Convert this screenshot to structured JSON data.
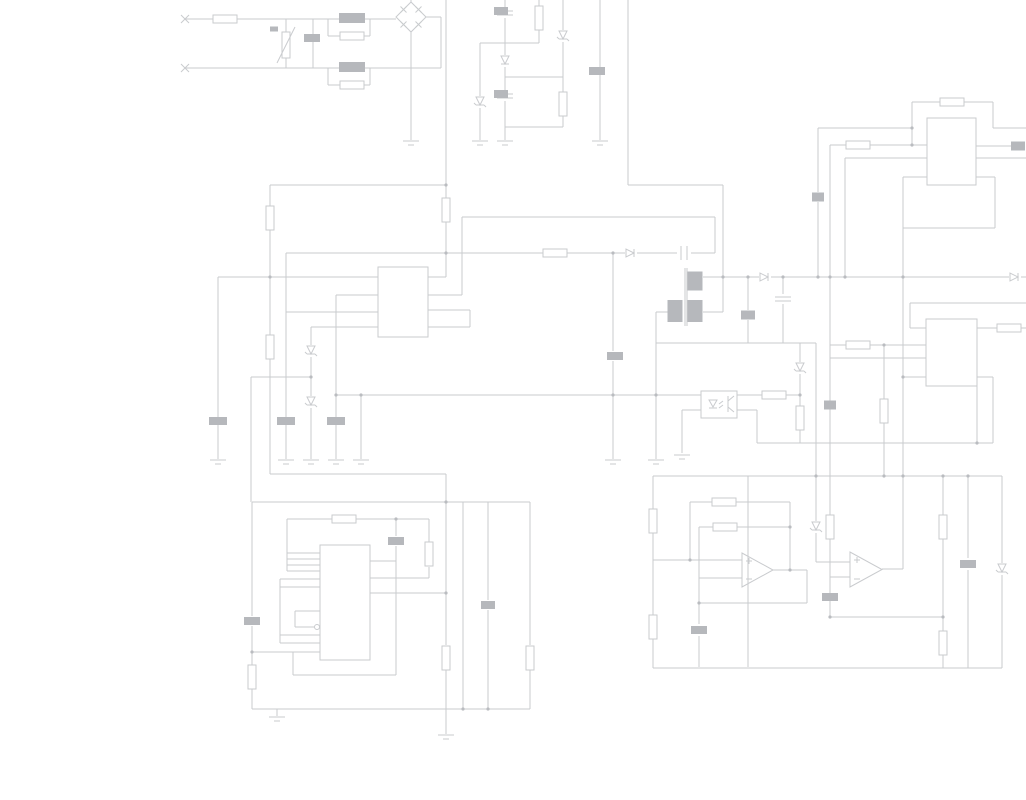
{
  "meta": {
    "type": "circuit-schematic",
    "width": 1026,
    "height": 800,
    "background": "#ffffff",
    "wire_color": "#c9cbce",
    "blob_color": "#b6b8bc",
    "dot_color": "#babcc0"
  },
  "wires": [
    [
      185,
      19,
      213,
      19
    ],
    [
      237,
      19,
      396,
      19
    ],
    [
      185,
      68,
      441,
      68
    ],
    [
      441,
      68,
      441,
      17
    ],
    [
      426,
      17,
      441,
      17
    ],
    [
      286,
      19,
      286,
      32
    ],
    [
      286,
      58,
      286,
      68
    ],
    [
      313,
      19,
      313,
      68
    ],
    [
      328,
      19,
      328,
      36
    ],
    [
      370,
      19,
      370,
      36
    ],
    [
      328,
      36,
      340,
      36
    ],
    [
      364,
      36,
      370,
      36
    ],
    [
      328,
      68,
      328,
      85
    ],
    [
      370,
      68,
      370,
      85
    ],
    [
      328,
      85,
      340,
      85
    ],
    [
      364,
      85,
      370,
      85
    ],
    [
      411,
      0,
      411,
      2
    ],
    [
      411,
      32,
      411,
      140
    ],
    [
      446,
      0,
      446,
      198
    ],
    [
      446,
      222,
      446,
      277
    ],
    [
      428,
      277,
      446,
      277
    ],
    [
      270,
      185,
      446,
      185
    ],
    [
      270,
      185,
      270,
      206
    ],
    [
      270,
      230,
      270,
      335
    ],
    [
      270,
      359,
      270,
      474
    ],
    [
      270,
      474,
      446,
      474
    ],
    [
      505,
      0,
      505,
      8
    ],
    [
      505,
      18,
      505,
      55
    ],
    [
      505,
      67,
      505,
      92
    ],
    [
      505,
      101,
      505,
      140
    ],
    [
      539,
      0,
      539,
      6
    ],
    [
      539,
      30,
      539,
      43
    ],
    [
      480,
      43,
      539,
      43
    ],
    [
      563,
      0,
      563,
      30
    ],
    [
      563,
      42,
      563,
      92
    ],
    [
      563,
      116,
      563,
      127
    ],
    [
      505,
      77,
      563,
      77
    ],
    [
      505,
      127,
      563,
      127
    ],
    [
      480,
      43,
      480,
      96
    ],
    [
      480,
      108,
      480,
      140
    ],
    [
      600,
      0,
      600,
      67
    ],
    [
      600,
      75,
      600,
      140
    ],
    [
      628,
      0,
      628,
      185
    ],
    [
      628,
      185,
      723,
      185
    ],
    [
      723,
      185,
      723,
      312
    ],
    [
      703,
      312,
      723,
      312
    ],
    [
      218,
      277,
      378,
      277
    ],
    [
      218,
      277,
      218,
      417
    ],
    [
      218,
      425,
      218,
      459
    ],
    [
      286,
      253,
      543,
      253
    ],
    [
      567,
      253,
      625,
      253
    ],
    [
      637,
      253,
      677,
      253
    ],
    [
      691,
      253,
      715,
      253
    ],
    [
      286,
      253,
      286,
      417
    ],
    [
      286,
      425,
      286,
      459
    ],
    [
      286,
      312,
      378,
      312
    ],
    [
      336,
      295,
      378,
      295
    ],
    [
      336,
      295,
      336,
      417
    ],
    [
      336,
      425,
      336,
      459
    ],
    [
      311,
      327,
      378,
      327
    ],
    [
      311,
      327,
      311,
      345
    ],
    [
      311,
      357,
      311,
      396
    ],
    [
      311,
      408,
      311,
      459
    ],
    [
      251,
      377,
      311,
      377
    ],
    [
      251,
      377,
      251,
      502
    ],
    [
      336,
      395,
      701,
      395
    ],
    [
      361,
      395,
      361,
      459
    ],
    [
      613,
      253,
      613,
      351
    ],
    [
      613,
      361,
      613,
      459
    ],
    [
      656,
      312,
      668,
      312
    ],
    [
      656,
      312,
      656,
      459
    ],
    [
      656,
      343,
      816,
      343
    ],
    [
      748,
      277,
      748,
      310
    ],
    [
      748,
      320,
      748,
      343
    ],
    [
      783,
      277,
      783,
      294
    ],
    [
      783,
      304,
      783,
      343
    ],
    [
      800,
      343,
      800,
      362
    ],
    [
      800,
      374,
      800,
      406
    ],
    [
      800,
      430,
      800,
      443
    ],
    [
      703,
      277,
      759,
      277
    ],
    [
      771,
      277,
      1009,
      277
    ],
    [
      1021,
      277,
      1026,
      277
    ],
    [
      715,
      217,
      715,
      253
    ],
    [
      462,
      217,
      715,
      217
    ],
    [
      462,
      217,
      462,
      295
    ],
    [
      428,
      295,
      462,
      295
    ],
    [
      428,
      310,
      470,
      310
    ],
    [
      428,
      327,
      470,
      327
    ],
    [
      470,
      310,
      470,
      327
    ],
    [
      737,
      395,
      762,
      395
    ],
    [
      786,
      395,
      800,
      395
    ],
    [
      701,
      410,
      682,
      410
    ],
    [
      682,
      410,
      682,
      453
    ],
    [
      737,
      410,
      757,
      410
    ],
    [
      757,
      410,
      757,
      443
    ],
    [
      757,
      443,
      993,
      443
    ],
    [
      816,
      343,
      816,
      476
    ],
    [
      816,
      476,
      816,
      521
    ],
    [
      816,
      533,
      816,
      562
    ],
    [
      816,
      562,
      850,
      562
    ],
    [
      830,
      145,
      830,
      401
    ],
    [
      830,
      409,
      830,
      476
    ],
    [
      830,
      476,
      830,
      515
    ],
    [
      830,
      539,
      830,
      577
    ],
    [
      830,
      577,
      850,
      577
    ],
    [
      830,
      577,
      830,
      617
    ],
    [
      845,
      158,
      845,
      277
    ],
    [
      818,
      128,
      912,
      128
    ],
    [
      818,
      128,
      818,
      192
    ],
    [
      818,
      202,
      818,
      277
    ],
    [
      830,
      145,
      846,
      145
    ],
    [
      870,
      145,
      927,
      145
    ],
    [
      845,
      158,
      927,
      158
    ],
    [
      912,
      102,
      912,
      145
    ],
    [
      912,
      102,
      940,
      102
    ],
    [
      964,
      102,
      993,
      102
    ],
    [
      993,
      102,
      993,
      128
    ],
    [
      993,
      128,
      1026,
      128
    ],
    [
      976,
      146,
      1011,
      146
    ],
    [
      976,
      158,
      1026,
      158
    ],
    [
      903,
      177,
      927,
      177
    ],
    [
      976,
      177,
      995,
      177
    ],
    [
      995,
      177,
      995,
      228
    ],
    [
      903,
      228,
      995,
      228
    ],
    [
      903,
      177,
      903,
      569
    ],
    [
      882,
      569,
      903,
      569
    ],
    [
      910,
      303,
      910,
      328
    ],
    [
      910,
      328,
      926,
      328
    ],
    [
      910,
      303,
      1026,
      303
    ],
    [
      830,
      345,
      846,
      345
    ],
    [
      870,
      345,
      926,
      345
    ],
    [
      884,
      345,
      884,
      399
    ],
    [
      884,
      423,
      884,
      476
    ],
    [
      830,
      358,
      926,
      358
    ],
    [
      903,
      377,
      993,
      377
    ],
    [
      993,
      377,
      993,
      443
    ],
    [
      977,
      328,
      997,
      328
    ],
    [
      1021,
      328,
      1026,
      328
    ],
    [
      977,
      386,
      977,
      443
    ],
    [
      653,
      476,
      1002,
      476
    ],
    [
      653,
      476,
      653,
      509
    ],
    [
      653,
      533,
      653,
      615
    ],
    [
      653,
      639,
      653,
      668
    ],
    [
      653,
      668,
      1002,
      668
    ],
    [
      653,
      560,
      742,
      560
    ],
    [
      690,
      502,
      690,
      560
    ],
    [
      690,
      502,
      712,
      502
    ],
    [
      736,
      502,
      790,
      502
    ],
    [
      790,
      502,
      790,
      570
    ],
    [
      699,
      578,
      742,
      578
    ],
    [
      699,
      527,
      699,
      624
    ],
    [
      699,
      636,
      699,
      667
    ],
    [
      699,
      527,
      713,
      527
    ],
    [
      737,
      527,
      790,
      527
    ],
    [
      773,
      570,
      807,
      570
    ],
    [
      807,
      570,
      807,
      603
    ],
    [
      699,
      603,
      807,
      603
    ],
    [
      748,
      476,
      748,
      667
    ],
    [
      830,
      617,
      943,
      617
    ],
    [
      943,
      476,
      943,
      515
    ],
    [
      943,
      539,
      943,
      631
    ],
    [
      943,
      655,
      943,
      668
    ],
    [
      968,
      476,
      968,
      558
    ],
    [
      968,
      570,
      968,
      668
    ],
    [
      1002,
      476,
      1002,
      563
    ],
    [
      1002,
      575,
      1002,
      668
    ],
    [
      252,
      502,
      530,
      502
    ],
    [
      252,
      502,
      252,
      616
    ],
    [
      252,
      626,
      252,
      665
    ],
    [
      252,
      689,
      252,
      709
    ],
    [
      287,
      519,
      332,
      519
    ],
    [
      356,
      519,
      429,
      519
    ],
    [
      287,
      519,
      287,
      571
    ],
    [
      287,
      553,
      320,
      553
    ],
    [
      287,
      559,
      320,
      559
    ],
    [
      287,
      565,
      320,
      565
    ],
    [
      287,
      571,
      320,
      571
    ],
    [
      280,
      579,
      280,
      643
    ],
    [
      280,
      579,
      320,
      579
    ],
    [
      280,
      587,
      320,
      587
    ],
    [
      280,
      635,
      320,
      635
    ],
    [
      280,
      643,
      320,
      643
    ],
    [
      320,
      611,
      295,
      611
    ],
    [
      295,
      611,
      295,
      627
    ],
    [
      295,
      627,
      314,
      627
    ],
    [
      252,
      652,
      320,
      652
    ],
    [
      370,
      561,
      396,
      561
    ],
    [
      396,
      519,
      396,
      536
    ],
    [
      396,
      546,
      396,
      675
    ],
    [
      370,
      578,
      429,
      578
    ],
    [
      429,
      519,
      429,
      542
    ],
    [
      429,
      567,
      429,
      578
    ],
    [
      370,
      593,
      446,
      593
    ],
    [
      293,
      675,
      396,
      675
    ],
    [
      293,
      652,
      293,
      675
    ],
    [
      446,
      474,
      446,
      645
    ],
    [
      446,
      670,
      446,
      709
    ],
    [
      446,
      709,
      446,
      734
    ],
    [
      463,
      502,
      463,
      709
    ],
    [
      488,
      502,
      488,
      600
    ],
    [
      488,
      610,
      488,
      709
    ],
    [
      530,
      502,
      530,
      645
    ],
    [
      530,
      670,
      530,
      709
    ],
    [
      252,
      709,
      530,
      709
    ],
    [
      277,
      709,
      277,
      716
    ]
  ],
  "resistors_h": [
    [
      225,
      19
    ],
    [
      352,
      36
    ],
    [
      352,
      85
    ],
    [
      555,
      253
    ],
    [
      344,
      519
    ],
    [
      724,
      502
    ],
    [
      725,
      527
    ],
    [
      858,
      145
    ],
    [
      952,
      102
    ],
    [
      858,
      345
    ],
    [
      1009,
      328
    ],
    [
      774,
      395
    ]
  ],
  "resistors_v": [
    [
      446,
      210
    ],
    [
      270,
      218
    ],
    [
      270,
      347
    ],
    [
      539,
      18
    ],
    [
      563,
      104
    ],
    [
      429,
      554
    ],
    [
      446,
      658
    ],
    [
      530,
      658
    ],
    [
      252,
      677
    ],
    [
      653,
      521
    ],
    [
      653,
      627
    ],
    [
      800,
      418
    ],
    [
      830,
      527
    ],
    [
      884,
      411
    ],
    [
      943,
      527
    ],
    [
      943,
      643
    ]
  ],
  "labels": [
    [
      312,
      38,
      16,
      8
    ],
    [
      274,
      29,
      8,
      5
    ],
    [
      352,
      18,
      26,
      10
    ],
    [
      352,
      67,
      26,
      10
    ],
    [
      501,
      11,
      14,
      8
    ],
    [
      501,
      94,
      14,
      8
    ],
    [
      597,
      71,
      16,
      8
    ],
    [
      615,
      356,
      16,
      8
    ],
    [
      218,
      421,
      18,
      8
    ],
    [
      286,
      421,
      18,
      8
    ],
    [
      336,
      421,
      18,
      8
    ],
    [
      818,
      197,
      12,
      9
    ],
    [
      830,
      405,
      12,
      9
    ],
    [
      748,
      315,
      14,
      9
    ],
    [
      1018,
      146,
      14,
      9
    ],
    [
      968,
      564,
      16,
      8
    ],
    [
      830,
      597,
      16,
      8
    ],
    [
      699,
      630,
      16,
      8
    ],
    [
      488,
      605,
      14,
      8
    ],
    [
      252,
      621,
      16,
      8
    ],
    [
      396,
      541,
      16,
      8
    ]
  ],
  "caps_on_vertical": [
    [
      505,
      13
    ],
    [
      505,
      96
    ],
    [
      783,
      299
    ]
  ],
  "caps_on_horizontal": [
    [
      684,
      253
    ]
  ],
  "diodes": [
    [
      631,
      253,
      "r"
    ],
    [
      765,
      277,
      "r"
    ],
    [
      1015,
      277,
      "r"
    ],
    [
      505,
      61,
      "d"
    ]
  ],
  "zeners": [
    [
      563,
      36
    ],
    [
      480,
      102
    ],
    [
      311,
      351
    ],
    [
      311,
      402
    ],
    [
      800,
      368
    ],
    [
      816,
      527
    ],
    [
      1002,
      569
    ]
  ],
  "grounds": [
    [
      411,
      141
    ],
    [
      480,
      141
    ],
    [
      505,
      141
    ],
    [
      600,
      141
    ],
    [
      218,
      460
    ],
    [
      286,
      460
    ],
    [
      311,
      460
    ],
    [
      336,
      460
    ],
    [
      361,
      460
    ],
    [
      613,
      460
    ],
    [
      656,
      460
    ],
    [
      682,
      455
    ],
    [
      277,
      717
    ],
    [
      446,
      735
    ]
  ],
  "dots": [
    [
      270,
      277
    ],
    [
      446,
      185
    ],
    [
      446,
      253
    ],
    [
      613,
      253
    ],
    [
      446,
      502
    ],
    [
      446,
      593
    ],
    [
      463,
      709
    ],
    [
      488,
      709
    ],
    [
      396,
      519
    ],
    [
      252,
      652
    ],
    [
      790,
      570
    ],
    [
      690,
      560
    ],
    [
      830,
      617
    ],
    [
      943,
      617
    ],
    [
      903,
      377
    ],
    [
      884,
      345
    ],
    [
      912,
      145
    ],
    [
      818,
      277
    ],
    [
      830,
      277
    ],
    [
      845,
      277
    ],
    [
      903,
      277
    ],
    [
      723,
      277
    ],
    [
      748,
      277
    ],
    [
      783,
      277
    ],
    [
      816,
      476
    ],
    [
      884,
      476
    ],
    [
      903,
      476
    ],
    [
      943,
      476
    ],
    [
      968,
      476
    ],
    [
      800,
      395
    ],
    [
      613,
      395
    ],
    [
      656,
      395
    ],
    [
      361,
      395
    ],
    [
      311,
      377
    ],
    [
      977,
      443
    ],
    [
      912,
      128
    ],
    [
      336,
      395
    ],
    [
      699,
      603
    ],
    [
      790,
      527
    ]
  ],
  "ic_boxes": [
    [
      378,
      267,
      50,
      70
    ],
    [
      927,
      118,
      49,
      67
    ],
    [
      926,
      319,
      51,
      67
    ],
    [
      320,
      545,
      50,
      115
    ]
  ],
  "opamps": [
    [
      742,
      553,
      31,
      34
    ],
    [
      850,
      552,
      32,
      35
    ]
  ],
  "optocoupler": {
    "x": 701,
    "y": 391,
    "w": 36,
    "h": 27
  },
  "bridge": {
    "cx": 411,
    "cy": 17,
    "r": 15
  },
  "varistor": {
    "x": 282,
    "y": 32,
    "w": 8,
    "h": 26
  },
  "transformer": {
    "cores": [
      [
        685,
        268,
        685,
        326
      ],
      [
        687,
        268,
        687,
        326
      ]
    ],
    "windings": [
      [
        695,
        281,
        15,
        19
      ],
      [
        675,
        311,
        15,
        22
      ],
      [
        695,
        311,
        15,
        22
      ]
    ]
  },
  "clock_bubble": {
    "cx": 317,
    "cy": 627,
    "r": 2.5
  },
  "terminals": [
    [
      185,
      19
    ],
    [
      185,
      68
    ]
  ]
}
